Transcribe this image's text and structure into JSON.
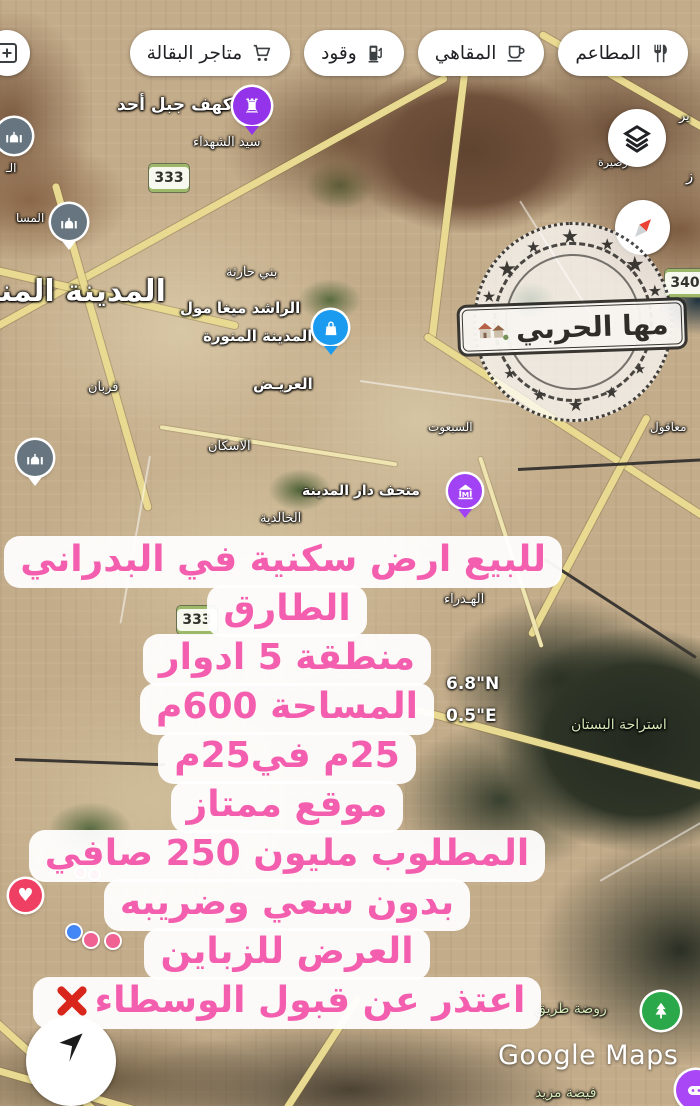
{
  "top_chips": [
    {
      "label": "المطاعم",
      "icon": "restaurant-icon"
    },
    {
      "label": "المقاهي",
      "icon": "cafe-icon"
    },
    {
      "label": "وقود",
      "icon": "fuel-icon"
    },
    {
      "label": "متاجر البقالة",
      "icon": "grocery-icon"
    }
  ],
  "map_labels": [
    {
      "text": "كهف جبل أحد",
      "x": 117,
      "y": 95,
      "size": 17,
      "weight": 700
    },
    {
      "text": "سيد الشهداء",
      "x": 193,
      "y": 135,
      "size": 13
    },
    {
      "text": "بني حارثة",
      "x": 226,
      "y": 265,
      "size": 13
    },
    {
      "text": "الراشد ميغا مول",
      "x": 180,
      "y": 299,
      "size": 15,
      "weight": 700
    },
    {
      "text": "المدينة المنورة",
      "x": 203,
      "y": 327,
      "size": 15,
      "weight": 700
    },
    {
      "text": "المدينة المنو",
      "x": -18,
      "y": 274,
      "size": 30,
      "weight": 700
    },
    {
      "text": "قربان",
      "x": 88,
      "y": 380,
      "size": 13
    },
    {
      "text": "العريـض",
      "x": 253,
      "y": 375,
      "size": 15,
      "weight": 700
    },
    {
      "text": "الاسكان",
      "x": 208,
      "y": 439,
      "size": 13
    },
    {
      "text": "السبعوت",
      "x": 428,
      "y": 420,
      "size": 12
    },
    {
      "text": "معاقول",
      "x": 650,
      "y": 420,
      "size": 12
    },
    {
      "text": "متحف دار المدينة",
      "x": 302,
      "y": 483,
      "size": 14,
      "weight": 700
    },
    {
      "text": "الخالدية",
      "x": 260,
      "y": 511,
      "size": 13
    },
    {
      "text": "الهـدراء",
      "x": 444,
      "y": 592,
      "size": 13
    },
    {
      "text": "استراحة البستان",
      "x": 571,
      "y": 717,
      "size": 14,
      "color": "#d4e6b5"
    },
    {
      "text": "روضة طريق",
      "x": 535,
      "y": 1001,
      "size": 14,
      "color": "#d4e6b5"
    },
    {
      "text": "فيضة مزيد",
      "x": 535,
      "y": 1085,
      "size": 14,
      "color": "#d4e6b5"
    },
    {
      "text": "رصيرة",
      "x": 598,
      "y": 156,
      "size": 11
    },
    {
      "text": "ير",
      "x": 679,
      "y": 109,
      "size": 13
    },
    {
      "text": "ز",
      "x": 686,
      "y": 167,
      "size": 15
    },
    {
      "text": "المسا",
      "x": 16,
      "y": 211,
      "size": 12
    },
    {
      "text": "الـ",
      "x": 6,
      "y": 161,
      "size": 12
    }
  ],
  "route_badges": [
    {
      "number": "333",
      "x": 148,
      "y": 163
    },
    {
      "number": "333",
      "x": 176,
      "y": 605
    },
    {
      "number": "340",
      "x": 664,
      "y": 268
    }
  ],
  "coordinates": {
    "lat": "6.8\"N",
    "lng": "0.5\"E"
  },
  "stamp": {
    "name": "مها الحربي"
  },
  "listing_lines": [
    {
      "text": "للبيع ارض سكنية في البدراني",
      "x_mark": false
    },
    {
      "text": "الطارق",
      "x_mark": false
    },
    {
      "text": "منطقة 5 ادوار",
      "x_mark": false
    },
    {
      "text": "المساحة 600م",
      "x_mark": false
    },
    {
      "text": "25م في25م",
      "x_mark": false
    },
    {
      "text": "موقع ممتاز",
      "x_mark": false
    },
    {
      "text": "المطلوب مليون 250 صافي",
      "x_mark": false
    },
    {
      "text": "بدون سعي وضريبه",
      "x_mark": false
    },
    {
      "text": "العرض للزباين",
      "x_mark": false
    },
    {
      "text": "اعتذر عن قبول الوسطاء",
      "x_mark": true
    }
  ],
  "attribution": "Google Maps",
  "colors": {
    "listing_text": "#f35fae",
    "chip_text": "#202124",
    "pin_blue": "#1a9bf0",
    "pin_purple_museum": "#a142f4",
    "pin_purple_castle": "#9333ea",
    "pin_gray_mosque": "#66757f",
    "pin_green": "#2ba84a",
    "pin_heart": "#ef3f63",
    "x_mark_red": "#d8261c"
  }
}
